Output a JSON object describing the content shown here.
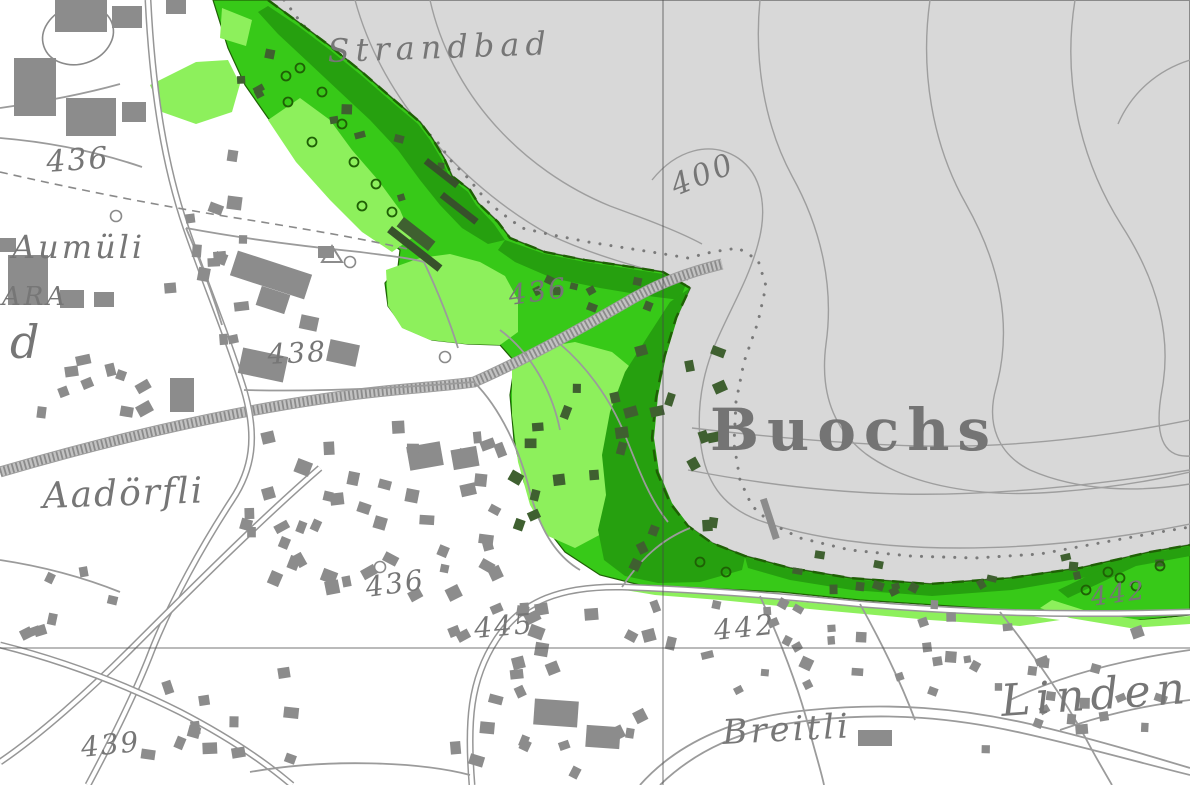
{
  "map": {
    "type": "topographic-map",
    "labels": [
      {
        "id": "strandbad",
        "text": "Strandbad",
        "x": 328,
        "y": 62,
        "size": 32,
        "rot": -2,
        "ls": 6,
        "kind": "place"
      },
      {
        "id": "elev-436-topleft",
        "text": "436",
        "x": 47,
        "y": 172,
        "size": 30,
        "rot": -4,
        "ls": 2,
        "kind": "elev"
      },
      {
        "id": "aumuli",
        "text": "Aumüli",
        "x": 12,
        "y": 258,
        "size": 32,
        "rot": 0,
        "ls": 3,
        "kind": "place"
      },
      {
        "id": "ara",
        "text": "ARA",
        "x": 2,
        "y": 305,
        "size": 26,
        "rot": 0,
        "ls": 3,
        "kind": "place"
      },
      {
        "id": "letter-d",
        "text": "d",
        "x": 10,
        "y": 358,
        "size": 46,
        "rot": 0,
        "ls": 0,
        "kind": "place"
      },
      {
        "id": "elev-438",
        "text": "438",
        "x": 268,
        "y": 364,
        "size": 28,
        "rot": -3,
        "ls": 2,
        "kind": "elev"
      },
      {
        "id": "depth-400",
        "text": "400",
        "x": 676,
        "y": 196,
        "size": 30,
        "rot": -22,
        "ls": 3,
        "kind": "elev"
      },
      {
        "id": "elev-436-rail",
        "text": "436",
        "x": 510,
        "y": 305,
        "size": 28,
        "rot": -8,
        "ls": 2,
        "kind": "elev"
      },
      {
        "id": "buochs",
        "text": "Buochs",
        "x": 710,
        "y": 450,
        "size": 58,
        "rot": 0,
        "ls": 8,
        "kind": "city"
      },
      {
        "id": "aadorfli",
        "text": "Aadörfli",
        "x": 43,
        "y": 508,
        "size": 36,
        "rot": -2,
        "ls": 2,
        "kind": "place"
      },
      {
        "id": "elev-436-mid",
        "text": "436",
        "x": 367,
        "y": 597,
        "size": 28,
        "rot": -8,
        "ls": 2,
        "kind": "elev"
      },
      {
        "id": "elev-445",
        "text": "445",
        "x": 475,
        "y": 638,
        "size": 28,
        "rot": -5,
        "ls": 2,
        "kind": "elev"
      },
      {
        "id": "elev-442-mid",
        "text": "442",
        "x": 715,
        "y": 640,
        "size": 28,
        "rot": -6,
        "ls": 3,
        "kind": "elev"
      },
      {
        "id": "elev-442-right",
        "text": "442",
        "x": 1092,
        "y": 606,
        "size": 26,
        "rot": -8,
        "ls": 2,
        "kind": "elev"
      },
      {
        "id": "breitli",
        "text": "Breitli",
        "x": 723,
        "y": 744,
        "size": 34,
        "rot": -3,
        "ls": 3,
        "kind": "place"
      },
      {
        "id": "linden",
        "text": "Linden",
        "x": 1002,
        "y": 716,
        "size": 44,
        "rot": -4,
        "ls": 6,
        "kind": "place"
      },
      {
        "id": "elev-439",
        "text": "439",
        "x": 82,
        "y": 757,
        "size": 28,
        "rot": -6,
        "ls": 2,
        "kind": "elev"
      }
    ],
    "colors": {
      "land": "#ffffff",
      "lake": "#d8d8d8",
      "contour": "#9e9e9e",
      "dotted": "#7a7a7a",
      "shore": "#8a8a8a",
      "green_light": "#8df05c",
      "green_mid": "#37c918",
      "green_dark": "#26a00f",
      "green_deep": "#1f6005",
      "bld": "#8c8c8c",
      "bldg": "#3f6030",
      "rail_base": "#c2c2c2",
      "rail_hatch": "#8b8b8b",
      "road_case": "#969696",
      "road_fill": "#ffffff",
      "road_minor": "#9b9b9b",
      "grid": "#474747",
      "text": "#767676"
    },
    "geometry": {
      "lake_points": "268,0 1190,0 1190,545 1150,552 1080,568 1010,578 930,584 850,578 790,568 745,556 712,543 688,526 670,503 657,472 652,438 656,398 664,358 676,318 690,288 663,272 625,266 585,260 545,252 510,238 498,222 478,203 470,190 452,176 444,158 432,138 420,122 393,99 362,72 330,46 298,22",
      "green_base_points": "213,0 268,0 298,22 330,46 362,72 393,99 420,122 432,138 444,158 452,176 470,190 478,203 498,222 510,238 545,252 585,260 625,266 663,272 690,288 676,318 664,358 656,398 652,438 657,472 670,503 688,526 712,543 745,556 790,568 850,578 930,584 1010,578 1080,568 1150,552 1190,545 1190,615 1120,622 1040,612 950,606 860,600 780,592 700,588 640,585 600,575 565,552 540,520 524,482 514,440 510,395 515,362 500,345 468,344 432,340 404,328 388,306 385,283 398,267 400,250 385,238 360,215 330,185 300,152 268,118 245,85 228,48",
      "green_light_polys": [
        "150,85 196,62 228,60 240,84 232,112 196,124 162,112",
        "222,8 252,20 246,46 220,38",
        "268,120 300,98 330,120 352,150 378,180 400,210 412,238 392,252 362,232 330,200 296,162",
        "386,270 420,258 450,254 480,262 505,276 518,300 518,332 500,345 465,344 430,340 402,328 388,306",
        "512,362 540,348 575,342 612,352 640,375 650,410 645,455 630,500 605,532 575,548 548,536 530,505 518,462 512,415",
        "628,585 700,592 780,600 870,608 960,612 1030,616 1060,620 1020,626 930,620 820,610 720,600 655,595 625,590",
        "1052,600 1090,612 1140,620 1190,616 1190,624 1130,628 1070,618 1040,608"
      ],
      "green_dark_polys": [
        "268,6 298,26 330,50 362,76 392,102 418,124 430,140 442,160 450,178 468,192 476,205 494,224 505,240 488,244 462,228 440,205 420,180 398,150 370,120 340,92 308,62 278,34 258,12",
        "505,240 545,254 585,262 625,268 663,274 686,284 680,300 648,296 600,288 552,278 515,262 498,250",
        "690,288 678,316 666,356 658,396 654,438 659,472 672,503 690,527 714,544 745,557 742,570 700,582 658,583 625,576 604,560 598,530 606,495 602,455 610,412 625,372 648,336 670,302",
        "745,557 790,569 850,579 930,585 1010,579 1080,569 1150,553 1190,546 1190,556 1150,562 1082,578 1012,590 932,596 852,590 790,580 748,568",
        "1058,590 1130,556 1190,548 1190,556 1136,566 1068,598"
      ],
      "contours": [
        "M 355,0 C 370,55 400,105 440,148 C 472,182 508,212 550,235 C 592,255 640,268 688,280",
        "M 430,0 C 440,45 462,88 494,124 C 526,160 566,188 610,206 C 648,220 680,232 702,244",
        "M 652,180 C 676,150 710,140 738,158 C 762,174 768,208 758,244 C 748,282 726,316 712,352 C 700,384 696,420 702,452 C 708,486 726,508 758,520 C 808,538 880,548 960,548 C 1040,548 1120,538 1190,524",
        "M 760,0 C 754,60 764,124 792,176 C 822,230 834,288 826,344 C 820,390 832,428 866,454 C 910,486 980,498 1056,492 C 1110,488 1156,480 1190,472",
        "M 930,0 C 920,70 932,144 966,204 C 1002,268 1012,330 996,388 C 986,424 998,454 1030,470 C 1080,492 1140,492 1190,484",
        "M 1075,0 C 1062,80 1080,160 1122,226 C 1158,282 1172,336 1162,390 C 1154,434 1162,458 1190,456",
        "M 1190,60 C 1158,70 1132,92 1118,124",
        "M 692,428 C 760,436 840,444 920,446 C 1010,448 1100,438 1190,420",
        "M 688,470 C 750,482 820,492 900,494 C 990,496 1090,486 1190,470"
      ],
      "dotted_lines": [
        "284,0 302,24 330,50 360,76 392,102 418,125 436,140 452,162 468,178 486,200 500,212 522,228 548,234 588,242 626,248 664,254 688,258 712,252 738,248 758,260 766,286 758,322 744,362 736,402 734,444 740,480 752,506 772,524 800,538 850,550 910,556 975,558 1040,554 1105,542 1160,532 1190,527"
      ],
      "shore_dash": "M 268,0 L 298,22 330,46 362,72 393,99 420,122 432,138 444,158 452,176 470,190 478,203 498,222 510,238 545,252 585,260 625,266 663,272 690,288 676,318 664,358 656,398 652,438 657,472 670,503 688,526 712,543 745,556 790,568 850,578 930,584 1010,578 1080,568 1150,552 1190,545",
      "railway": [
        "M 0,472 C 130,434 270,402 395,390 C 440,386 462,384 474,382 C 520,362 575,332 625,303 C 660,282 690,272 722,264"
      ],
      "roads_main": [
        "M 148,0 C 152,80 162,158 186,228 C 206,286 226,332 244,390 C 258,438 252,470 232,500 C 202,546 172,600 152,650 C 136,692 112,740 88,785",
        "M 472,785 C 467,722 470,680 496,640 C 522,600 562,586 622,587 C 700,590 760,594 860,604 C 960,612 1060,616 1190,612",
        "M 320,468 C 260,520 190,590 130,650 C 90,690 40,735 0,762",
        "M 0,645 C 60,660 120,682 180,712 C 230,738 265,762 292,785"
      ],
      "roads_minor": [
        "M 186,228 C 240,238 300,246 360,252 C 390,256 410,258 424,262",
        "M 244,390 C 320,392 400,388 474,382",
        "M 474,382 C 500,408 520,450 530,492 C 540,530 556,556 580,570",
        "M 560,344 C 586,366 610,398 625,435 C 638,468 650,500 668,522",
        "M 500,330 C 530,352 552,390 560,430",
        "M 622,587 C 640,560 660,540 690,528",
        "M 760,596 C 780,640 800,690 812,740 C 818,762 822,775 824,785",
        "M 1000,612 C 1030,650 1066,700 1092,750 C 1102,768 1108,778 1112,785",
        "M 860,604 C 880,640 900,680 915,720",
        "M 0,560 C 40,566 80,576 120,592",
        "M 1190,650 C 1120,660 1060,676 1010,700",
        "M 1190,700 C 1140,706 1100,716 1060,730",
        "M 0,108 C 42,102 84,94 120,84",
        "M 0,138 C 48,142 98,152 142,167",
        "M 186,228 C 200,260 212,292 222,325",
        "M 424,262 C 438,292 450,322 458,348",
        "M 250,772 C 330,758 420,762 470,775",
        "M 640,785 C 680,740 740,716 810,710 C 890,702 960,708 1030,724 C 1090,738 1150,756 1190,768",
        "M 660,785 C 698,748 750,726 815,720 C 890,712 955,718 1022,733 C 1085,747 1145,764 1190,775"
      ],
      "footpaths": [
        "M 0,172 C 70,188 150,204 230,217 C 300,228 360,238 412,250"
      ],
      "grid": {
        "x": 663,
        "y": 648
      },
      "oval": {
        "cx": 78,
        "cy": 35,
        "rx": 36,
        "ry": 29,
        "rot": -18
      },
      "buildings": [
        [
          55,
          0,
          52,
          32,
          0
        ],
        [
          112,
          6,
          30,
          22,
          0
        ],
        [
          166,
          0,
          20,
          14,
          0
        ],
        [
          14,
          58,
          42,
          58,
          0
        ],
        [
          66,
          98,
          50,
          38,
          0
        ],
        [
          122,
          102,
          24,
          20,
          0
        ],
        [
          0,
          238,
          16,
          14,
          0
        ],
        [
          8,
          255,
          40,
          50,
          0
        ],
        [
          60,
          290,
          24,
          18,
          0
        ],
        [
          94,
          292,
          20,
          15,
          0
        ],
        [
          232,
          262,
          78,
          26,
          18
        ],
        [
          258,
          290,
          30,
          20,
          18
        ],
        [
          318,
          246,
          16,
          12,
          0
        ],
        [
          240,
          352,
          46,
          26,
          12
        ],
        [
          328,
          342,
          30,
          22,
          12
        ],
        [
          300,
          316,
          18,
          14,
          12
        ],
        [
          170,
          378,
          24,
          34,
          0
        ],
        [
          408,
          444,
          34,
          24,
          -10
        ],
        [
          452,
          448,
          26,
          20,
          -10
        ],
        [
          534,
          700,
          44,
          26,
          4
        ],
        [
          586,
          726,
          34,
          22,
          4
        ],
        [
          858,
          730,
          34,
          16,
          0
        ]
      ],
      "buildings_dark": [
        [
          396,
          228,
          40,
          12,
          38
        ]
      ],
      "clusters": [
        [
          160,
          132,
          262,
          348,
          14,
          8,
          16,
          "bld",
          11
        ],
        [
          28,
          352,
          205,
          432,
          10,
          9,
          16,
          "bld",
          22
        ],
        [
          228,
          418,
          505,
          600,
          44,
          8,
          16,
          "bld",
          33
        ],
        [
          128,
          658,
          300,
          782,
          12,
          9,
          15,
          "bld",
          44
        ],
        [
          428,
          598,
          700,
          782,
          30,
          8,
          15,
          "bld",
          55
        ],
        [
          700,
          598,
          980,
          702,
          26,
          7,
          13,
          "bld",
          66
        ],
        [
          980,
          618,
          1185,
          782,
          18,
          7,
          13,
          "bld",
          77
        ],
        [
          545,
          342,
          735,
          582,
          22,
          8,
          14,
          "bldg",
          88
        ],
        [
          748,
          550,
          1180,
          602,
          15,
          6,
          11,
          "bldg",
          99
        ],
        [
          505,
          418,
          562,
          542,
          6,
          8,
          13,
          "bldg",
          111
        ],
        [
          235,
          35,
          455,
          235,
          10,
          6,
          11,
          "bldg",
          122
        ],
        [
          515,
          262,
          692,
          318,
          8,
          6,
          10,
          "bldg",
          133
        ],
        [
          0,
          558,
          120,
          660,
          7,
          8,
          13,
          "bld",
          144
        ]
      ],
      "piers": [
        [
          428,
          158,
          40,
          7,
          38,
          "#37512b"
        ],
        [
          444,
          192,
          44,
          7,
          38,
          "#37512b"
        ],
        [
          392,
          226,
          64,
          8,
          38,
          "#37512b"
        ],
        [
          760,
          500,
          7,
          42,
          -18,
          "#8c8c8c"
        ]
      ],
      "trees": [
        [
          300,
          68
        ],
        [
          322,
          92
        ],
        [
          288,
          102
        ],
        [
          342,
          124
        ],
        [
          312,
          142
        ],
        [
          354,
          162
        ],
        [
          376,
          184
        ],
        [
          362,
          206
        ],
        [
          392,
          212
        ],
        [
          286,
          76
        ],
        [
          1108,
          572
        ],
        [
          1136,
          586
        ],
        [
          1160,
          566
        ],
        [
          1086,
          590
        ],
        [
          700,
          562
        ],
        [
          726,
          572
        ],
        [
          1120,
          578
        ]
      ],
      "white_circles": [
        [
          350,
          262
        ],
        [
          445,
          357
        ],
        [
          380,
          567
        ],
        [
          116,
          216
        ]
      ],
      "triangle": "322,262 342,262 332,246"
    }
  }
}
